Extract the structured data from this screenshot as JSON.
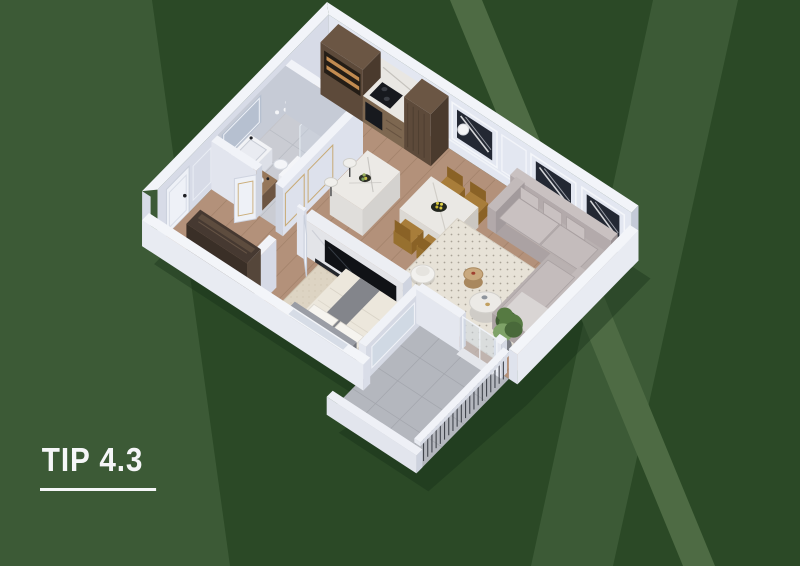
{
  "title": {
    "text": "TIP 4.3"
  },
  "palette": {
    "bg_base": "#2b4926",
    "bg_panel": "#3c5a36",
    "bg_stripe": "#4e6b44",
    "shadow": "#16301a",
    "wall_top": "#f2f4f9",
    "wall_light": "#e3e7f1",
    "wall_mid": "#d7dbe7",
    "wall_dark": "#c4cad8",
    "wall_shade": "#b9bfcf",
    "bath_wall": "#c6cbd6",
    "floor_wood": "#b3917a",
    "floor_wood_line": "#8d6f57",
    "floor_bath": "#caccd3",
    "floor_balcony": "#b4b7be",
    "carpet": "#ddd4c3",
    "rug": "#e7e2d7",
    "kitchen_wood": "#5d4a3a",
    "kitchen_wood_dark": "#46382c",
    "kitchen_glow": "#c28b50",
    "counter": "#e9e7e3",
    "black": "#17191e",
    "marble": "#eceae6",
    "art": "#232833",
    "gold": "#c5a468",
    "chair": "#a87d3a",
    "chair_dark": "#8a6226",
    "sofa": "#b9b1b1",
    "sofa_dark": "#9b9294",
    "sofa_light": "#c9c1c1",
    "bed": "#ece7dc",
    "bed_runner": "#83858b",
    "headboard": "#9a9da5",
    "wardrobe": "#463931",
    "plant_dark": "#3f5c33",
    "plant_mid": "#567a42",
    "plant_light": "#7fa368",
    "glass": "#cdd8e4",
    "title_color": "#f5f6f8"
  }
}
